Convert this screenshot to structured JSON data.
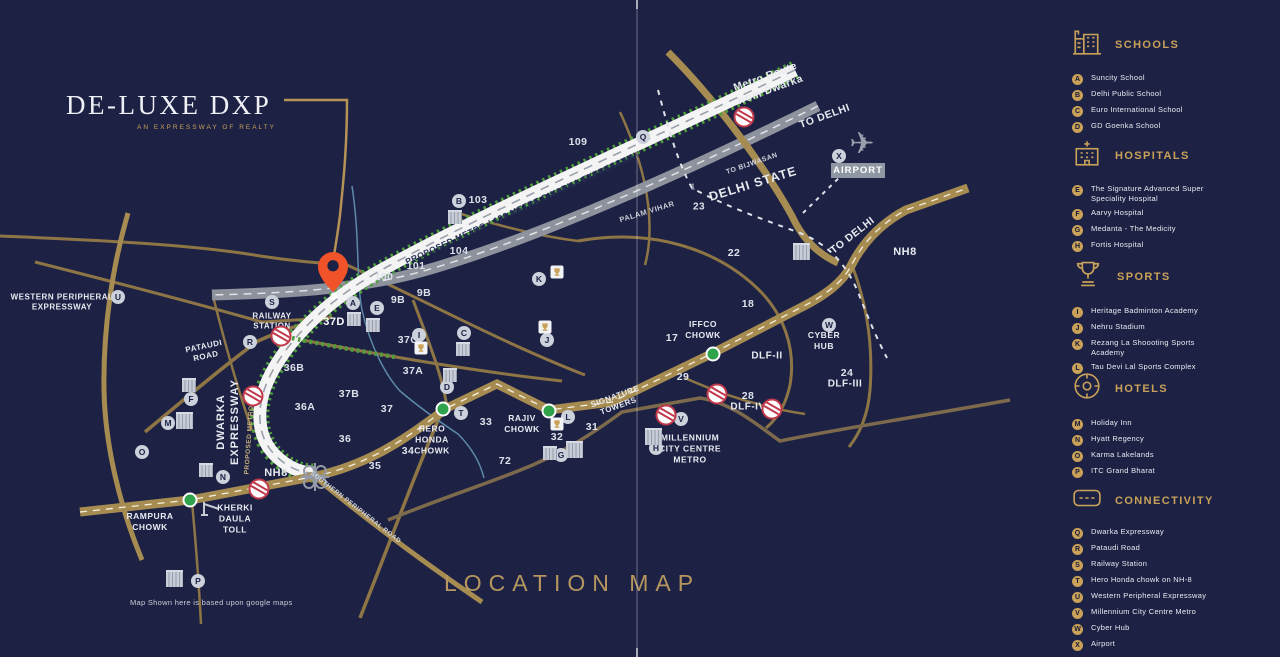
{
  "logo": {
    "title": "DE-LUXE DXP",
    "tagline": "AN EXPRESSWAY OF REALTY"
  },
  "footer": {
    "location_map_title": "LOCATION MAP",
    "disclaimer": "Map Shown here is based upon google maps"
  },
  "colors": {
    "background": "#1d2245",
    "accent_gold": "#c9a158",
    "road_gold": "#a78c52",
    "road_white": "#f4f4f5",
    "metro_green": "#4f9e3c",
    "pin_orange": "#f0532a",
    "crossing_red": "#c0394b",
    "chowk_green": "#2fa24c"
  },
  "legend": {
    "sections": [
      {
        "title": "SCHOOLS",
        "icon": "school-building-icon",
        "items": [
          {
            "key": "A",
            "label": "Suncity School"
          },
          {
            "key": "B",
            "label": "Delhi Public School"
          },
          {
            "key": "C",
            "label": "Euro International School"
          },
          {
            "key": "D",
            "label": "GD Goenka School"
          }
        ]
      },
      {
        "title": "HOSPITALS",
        "icon": "hospital-building-icon",
        "items": [
          {
            "key": "E",
            "label": "The Signature Advanced Super Speciality Hospital"
          },
          {
            "key": "F",
            "label": "Aarvy Hospital"
          },
          {
            "key": "G",
            "label": "Medanta - The Medicity"
          },
          {
            "key": "H",
            "label": "Fortis Hospital"
          }
        ]
      },
      {
        "title": "SPORTS",
        "icon": "trophy-icon",
        "items": [
          {
            "key": "I",
            "label": "Heritage Badminton Academy"
          },
          {
            "key": "J",
            "label": "Nehru Stadium"
          },
          {
            "key": "K",
            "label": "Rezang La Shoooting Sports Academy"
          },
          {
            "key": "L",
            "label": "Tau Devi Lal Sports Complex"
          }
        ]
      },
      {
        "title": "HOTELS",
        "icon": "hotel-compass-icon",
        "items": [
          {
            "key": "M",
            "label": "Holiday Inn"
          },
          {
            "key": "N",
            "label": "Hyatt Regency"
          },
          {
            "key": "O",
            "label": "Karma Lakelands"
          },
          {
            "key": "P",
            "label": "ITC Grand Bharat"
          }
        ]
      },
      {
        "title": "CONNECTIVITY",
        "icon": "road-icon",
        "items": [
          {
            "key": "Q",
            "label": "Dwarka Expressway"
          },
          {
            "key": "R",
            "label": "Pataudi Road"
          },
          {
            "key": "S",
            "label": "Railway Station"
          },
          {
            "key": "T",
            "label": "Hero Honda chowk on NH-8"
          },
          {
            "key": "U",
            "label": "Western Peripheral Expressway"
          },
          {
            "key": "V",
            "label": "Millennium City Centre Metro"
          },
          {
            "key": "W",
            "label": "Cyber Hub"
          },
          {
            "key": "X",
            "label": "Airport"
          }
        ]
      }
    ]
  },
  "map": {
    "pin": {
      "sector": "37D"
    },
    "labels": {
      "metro_route": "Metro Route\nfrom Dwarka",
      "to_delhi_metro": "TO DELHI",
      "to_bijwasan": "TO BIJWASAN",
      "delhi_state": "DELHI STATE",
      "palam_vihar": "PALAM VIHAR",
      "airport": "AIRPORT",
      "expressway_banner": "PROPOSED METRO / 150 METRE DWARKA EXPRESSWAY",
      "western_peripheral": "WESTERN PERIPHERAL\nEXPRESSWAY",
      "railway_station": "RAILWAY\nSTATION",
      "pataudi_road": "PATAUDI\nROAD",
      "dwarka_word": "DWARKA",
      "expressway_word": "EXPRESSWAY",
      "proposed_metro_small": "PROPOSED METRO",
      "nh8_toll": "NH8",
      "nh8_delhi": "NH8",
      "to_delhi_nh8": "TO DELHI",
      "kherki_daula": "KHERKI\nDAULA\nTOLL",
      "rampura": "RAMPURA\nCHOWK",
      "southern_peripheral": "SOUTHERN PERIPHERAL ROAD",
      "hero_honda": "HERO\nHONDA\nCHOWK",
      "rajiv": "RAJIV\nCHOWK",
      "signature_towers": "SIGNATURE\nTOWERS",
      "millennium": "MILLENNIUM\nCITY CENTRE\nMETRO",
      "iffco": "IFFCO\nCHOWK",
      "cyber_hub": "CYBER\nHUB",
      "dlf2": "DLF-II",
      "dlf3": "DLF-III",
      "dlf4": "DLF-IV"
    },
    "sectors": [
      {
        "n": "109"
      },
      {
        "n": "103"
      },
      {
        "n": "104"
      },
      {
        "n": "101"
      },
      {
        "n": "100"
      },
      {
        "n": "9B"
      },
      {
        "n": "9B"
      },
      {
        "n": "37C"
      },
      {
        "n": "37A"
      },
      {
        "n": "36B"
      },
      {
        "n": "37B"
      },
      {
        "n": "36A"
      },
      {
        "n": "37"
      },
      {
        "n": "36"
      },
      {
        "n": "35"
      },
      {
        "n": "34"
      },
      {
        "n": "33"
      },
      {
        "n": "72"
      },
      {
        "n": "32"
      },
      {
        "n": "31"
      },
      {
        "n": "29"
      },
      {
        "n": "28"
      },
      {
        "n": "24"
      },
      {
        "n": "23"
      },
      {
        "n": "22"
      },
      {
        "n": "18"
      },
      {
        "n": "17"
      },
      {
        "n": "1"
      }
    ],
    "markers": [
      {
        "letter": "A"
      },
      {
        "letter": "B"
      },
      {
        "letter": "C"
      },
      {
        "letter": "D"
      },
      {
        "letter": "E"
      },
      {
        "letter": "F"
      },
      {
        "letter": "G"
      },
      {
        "letter": "H"
      },
      {
        "letter": "I"
      },
      {
        "letter": "J"
      },
      {
        "letter": "K"
      },
      {
        "letter": "L"
      },
      {
        "letter": "M"
      },
      {
        "letter": "N"
      },
      {
        "letter": "O"
      },
      {
        "letter": "P"
      },
      {
        "letter": "Q"
      },
      {
        "letter": "R"
      },
      {
        "letter": "S"
      },
      {
        "letter": "T"
      },
      {
        "letter": "U"
      },
      {
        "letter": "V"
      },
      {
        "letter": "W"
      },
      {
        "letter": "X"
      }
    ]
  }
}
